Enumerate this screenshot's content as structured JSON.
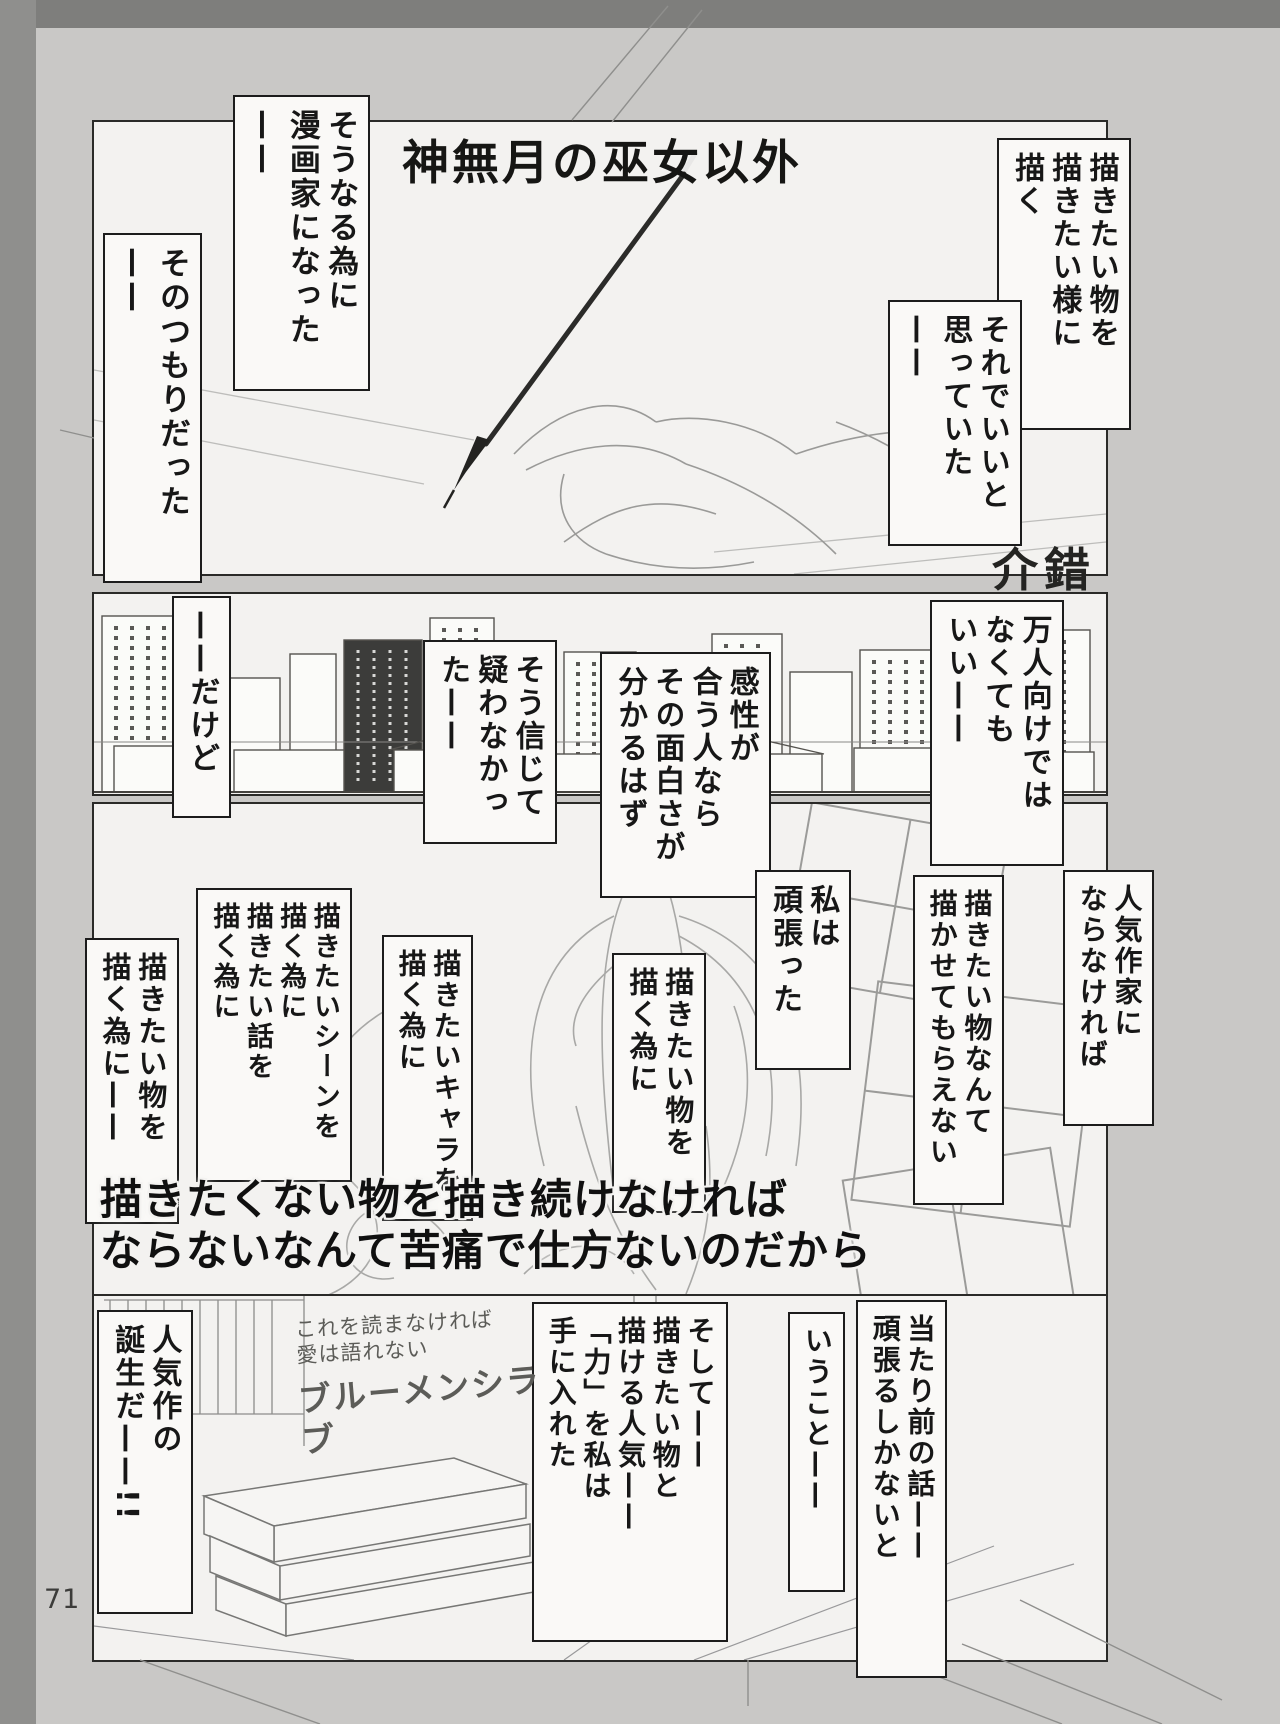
{
  "colors": {
    "surround": "#9a9a98",
    "surround_dark": "#7e7e7c",
    "paper": "#c9c8c6",
    "panel_white": "#f3f2f0",
    "caption_box": "#faf9f7",
    "ink": "#171717",
    "sketch_gray": "#a0a09e"
  },
  "title": "神無月の巫女以外",
  "artist": "介錯",
  "page_number": "71",
  "p1": {
    "boxes": [
      "そうなる為に\n漫画家になった\n——",
      "そのつもりだった\n——",
      "描きたい物を\n描きたい様に\n描く",
      "それでいいと\n思っていた——"
    ]
  },
  "p2": {
    "boxes": [
      "——だけど",
      "そう信じて\n疑わなかっ\nた——",
      "感性が\n合う人なら\nその面白さが\n分かるはず",
      "万人向けでは\nなくても\nいい——"
    ]
  },
  "p3": {
    "boxes": [
      "描きたい物を\n描く為に——",
      "描きたいシーンを\n描く為に\n描きたい話を\n描く為に",
      "描きたいキャラを\n描く為に",
      "描きたい物を\n描く為に",
      "私は\n頑張った",
      "描きたい物なんて\n描かせてもらえない",
      "人気作家に\nならなければ"
    ],
    "emphasis": "描きたくない物を描き続けなければ\nならないなんて苦痛で仕方ないのだから"
  },
  "p4": {
    "boxes": [
      "人気作の\n誕生だ——!!",
      "そして——\n描きたい物と\n描ける人気——\n「力」を私は\n手に入れた",
      "当たり前の話——\n頑張るしかないと",
      "いうこと——"
    ],
    "handwriting": {
      "line1": "これを読まなければ",
      "line2": "愛は語れない",
      "line3": "ブルーメンシラブ"
    }
  }
}
